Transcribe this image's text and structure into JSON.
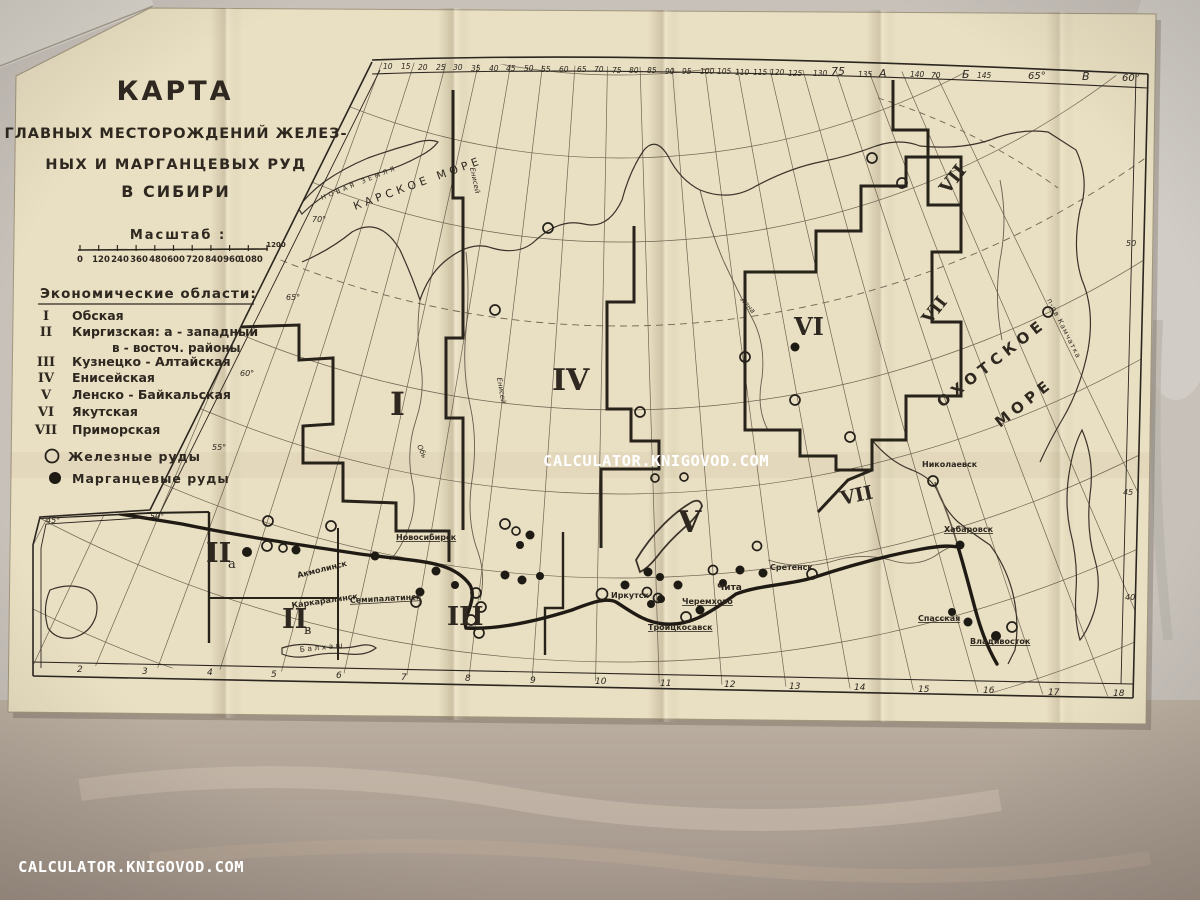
{
  "watermarks": {
    "center": "CALCULATOR.KNIGOVOD.COM",
    "corner": "CALCULATOR.KNIGOVOD.COM"
  },
  "title": {
    "l1": "КАРТА",
    "l2": "ГЛАВНЫХ  МЕСТОРОЖДЕНИЙ  ЖЕЛЕЗ-",
    "l3": "НЫХ  И  МАРГАНЦЕВЫХ  РУД",
    "l4": "В  СИБИРИ"
  },
  "scale": {
    "label": "Масштаб :",
    "ticks": [
      "0",
      "120",
      "240",
      "360",
      "480",
      "600",
      "720",
      "840",
      "960",
      "1080"
    ],
    "end_label": "1200"
  },
  "regions_list": {
    "header": "Экономические  области:",
    "items": [
      {
        "n": "I",
        "name": "Обская"
      },
      {
        "n": "II",
        "name": "Киргизская: а - западный"
      },
      {
        "n": "",
        "name": "в - восточ. районы"
      },
      {
        "n": "III",
        "name": "Кузнецко - Алтайская"
      },
      {
        "n": "IV",
        "name": "Енисейская"
      },
      {
        "n": "V",
        "name": "Ленско - Байкальская"
      },
      {
        "n": "VI",
        "name": "Якутская"
      },
      {
        "n": "VII",
        "name": "Приморская"
      }
    ]
  },
  "legend": {
    "iron": "Железные руды",
    "manganese": "Марганцевые руды"
  },
  "labels": {
    "kara_sea": "КАРСКОЕ  МОРЕ",
    "okhotsk1": "ОХОТСКОЕ",
    "okhotsk2": "МОРЕ",
    "novaya_zemlya": "НОВАЯ ЗЕМЛЯ",
    "kamchatka": "п-ов Камчатка",
    "balkhash": "Балхаш",
    "ob": "Обь",
    "yenisei1": "Енисей",
    "yenisei2": "Енисей",
    "lena": "Лена"
  },
  "map_numerals": {
    "r1": "I",
    "r2a_n": "II",
    "r2a_s": "а",
    "r2b_n": "II",
    "r2b_s": "в",
    "r3": "III",
    "r4": "IV",
    "r5": "V",
    "r6": "VI",
    "r7_top": "VII",
    "r7_mid": "VII",
    "r7_east": "VII"
  },
  "cities": [
    {
      "name": "Новосибирск"
    },
    {
      "name": "Акмолинск"
    },
    {
      "name": "Каркаралинск"
    },
    {
      "name": "Семипалатинск"
    },
    {
      "name": "Иркутск"
    },
    {
      "name": "Черемхово"
    },
    {
      "name": "Чита"
    },
    {
      "name": "Сретенск"
    },
    {
      "name": "Троицкосавск"
    },
    {
      "name": "Хабаровск"
    },
    {
      "name": "Спасская"
    },
    {
      "name": "Владивосток"
    },
    {
      "name": "Николаевск"
    }
  ],
  "graticule": {
    "top_numbers": [
      "10",
      "15",
      "20",
      "25",
      "30",
      "35",
      "40",
      "45",
      "50",
      "55",
      "60",
      "65",
      "70",
      "75",
      "80",
      "85",
      "90",
      "95",
      "100",
      "105",
      "110",
      "115",
      "120",
      "125"
    ],
    "top_right": [
      "130",
      "75",
      "135",
      "А",
      "140",
      "70",
      "Б",
      "145",
      "65°",
      "В",
      "60°"
    ],
    "bottom_numbers": [
      "2",
      "3",
      "4",
      "5",
      "6",
      "7",
      "8",
      "9",
      "10",
      "11",
      "12",
      "13",
      "14",
      "15",
      "16",
      "17",
      "18"
    ],
    "left_lat": [
      "70°",
      "65°",
      "60°",
      "55°",
      "50°",
      "45°"
    ],
    "right_lat": [
      "50",
      "45",
      "40"
    ]
  }
}
